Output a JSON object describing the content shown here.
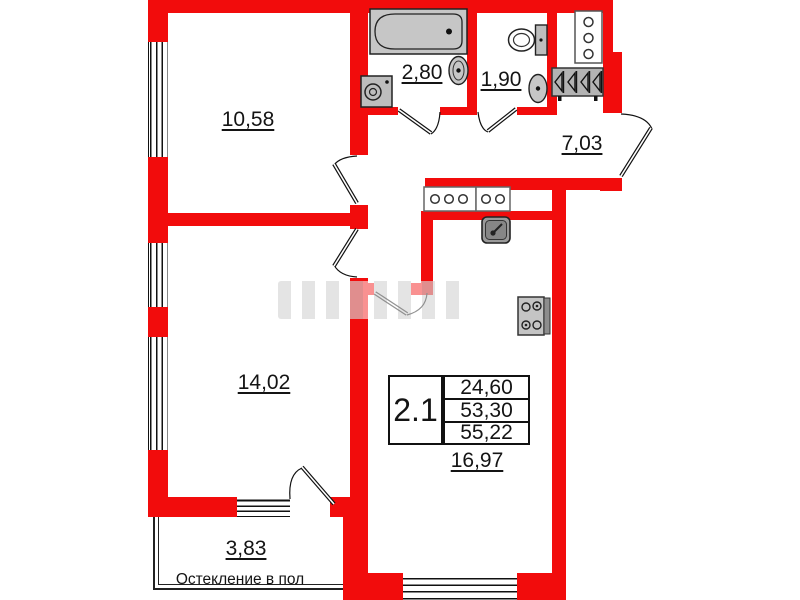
{
  "colors": {
    "wall": "#f20c0c",
    "line": "#141414",
    "fixture": "#c6c6c6",
    "fixturedark": "#8d8d8d"
  },
  "rooms": [
    {
      "name": "bedroom-1",
      "area": "10,58"
    },
    {
      "name": "bathroom",
      "area": "2,80"
    },
    {
      "name": "wc",
      "area": "1,90"
    },
    {
      "name": "hallway",
      "area": "7,03"
    },
    {
      "name": "bedroom-2",
      "area": "14,02"
    },
    {
      "name": "kitchen-living",
      "area": "16,97"
    },
    {
      "name": "balcony",
      "area": "3,83"
    }
  ],
  "balcony_note": "Остекление в пол",
  "info_table": {
    "unit_type": "2.1",
    "rows": [
      "24,60",
      "53,30",
      "55,22"
    ]
  },
  "fixtures": [
    "bathtub-icon",
    "washing-machine-icon",
    "wash-basin-icon",
    "toilet-icon",
    "vent-shaft-icon",
    "wardrobe-icon",
    "kitchen-vent-icon",
    "kitchen-sink-icon",
    "stove-icon"
  ]
}
